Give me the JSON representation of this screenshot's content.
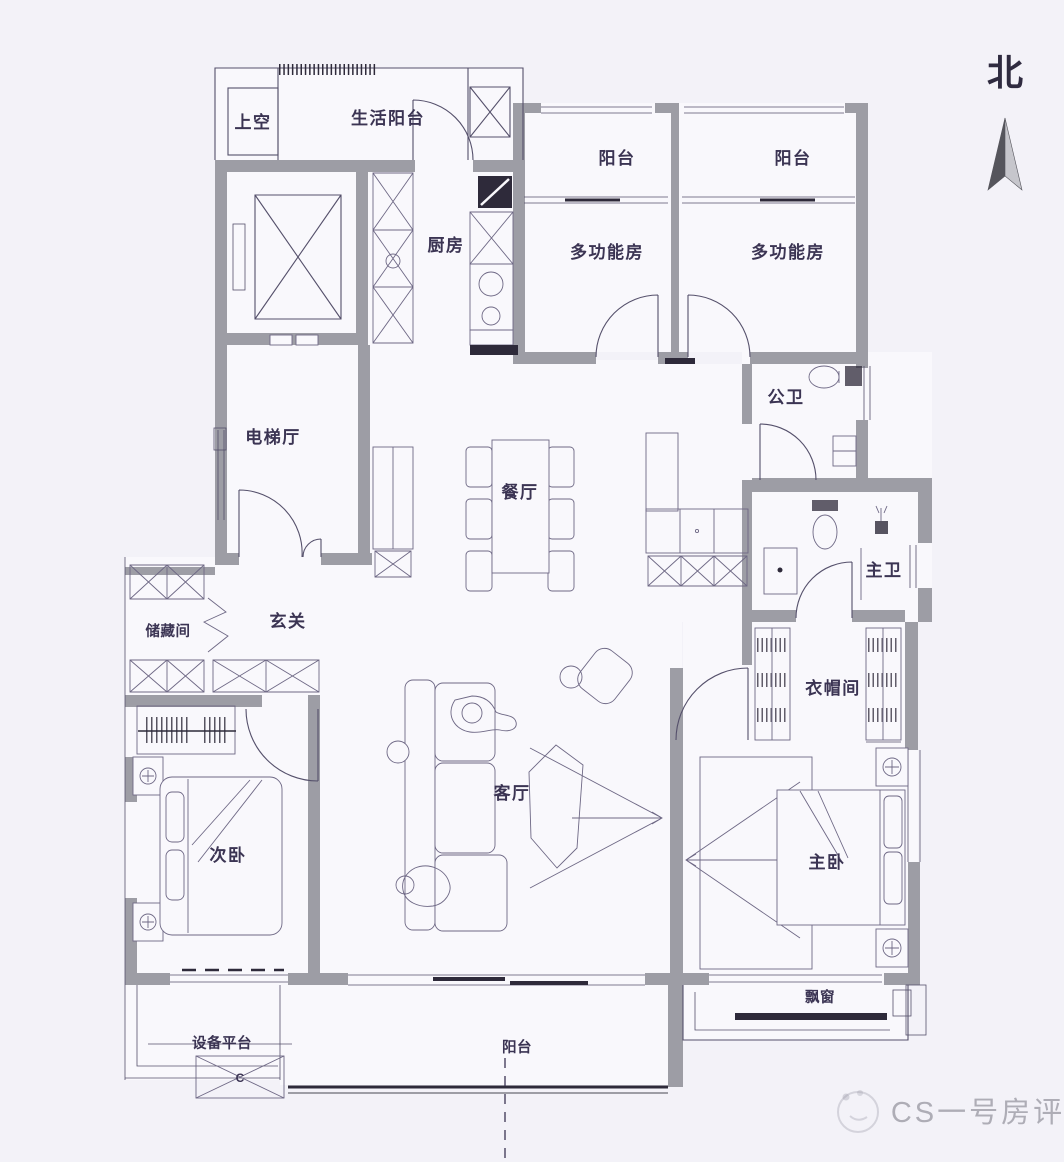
{
  "compass": {
    "north_label": "北"
  },
  "rooms": {
    "void_above": "上空",
    "service_balcony": "生活阳台",
    "north_balcony_left": "阳台",
    "north_balcony_right": "阳台",
    "multi_function_left": "多功能房",
    "multi_function_right": "多功能房",
    "kitchen": "厨房",
    "public_bathroom": "公卫",
    "elevator_hall": "电梯厅",
    "dining_room": "餐厅",
    "foyer": "玄关",
    "storage_room": "储藏间",
    "master_bathroom": "主卫",
    "cloakroom": "衣帽间",
    "living_room": "客厅",
    "second_bedroom": "次卧",
    "master_bedroom": "主卧",
    "bay_window": "飘窗",
    "equipment_platform": "设备平台",
    "south_balcony": "阳台"
  },
  "fixtures": {
    "ac_unit_label": "C"
  },
  "watermark": {
    "brand_text": "CS一号房评"
  },
  "colors": {
    "background": "#f3f2f8",
    "floor": "#f9f8fc",
    "wall": "#9d9da5",
    "line": "#55506b",
    "furniture": "#6e6885",
    "dark": "#2e2a3a",
    "text": "#3b3453",
    "arrow_dark": "#55555c",
    "arrow_light": "#c6c6cc",
    "watermark": "#84848f"
  }
}
